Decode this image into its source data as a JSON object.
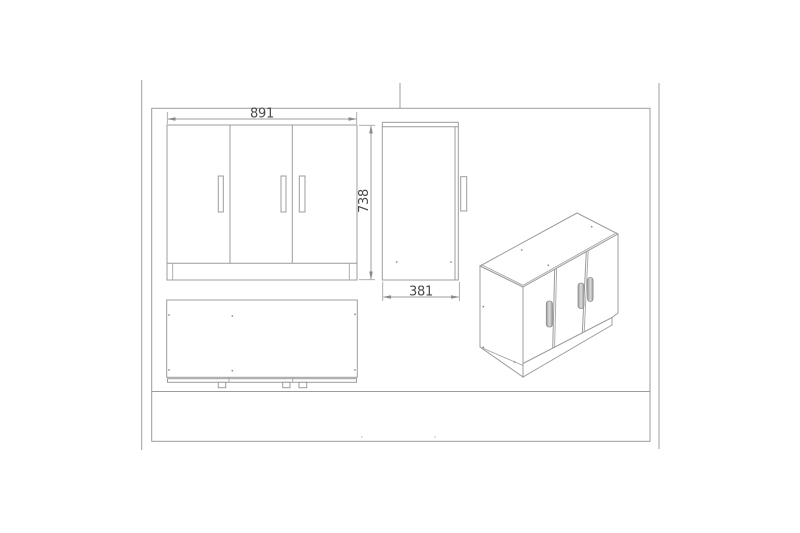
{
  "drawing": {
    "subject": "three-door-cabinet-orthographic-and-isometric-views"
  },
  "dimension_labels": {
    "width": "891",
    "height": "738",
    "depth": "381"
  },
  "colors": {
    "background": "#ffffff",
    "line": "#9c9c9c",
    "text": "#4a4a4a",
    "arrow": "#8a8a8a",
    "handle_fill_dark": "#9a9a9a",
    "handle_fill_light": "#dcdcdc"
  }
}
